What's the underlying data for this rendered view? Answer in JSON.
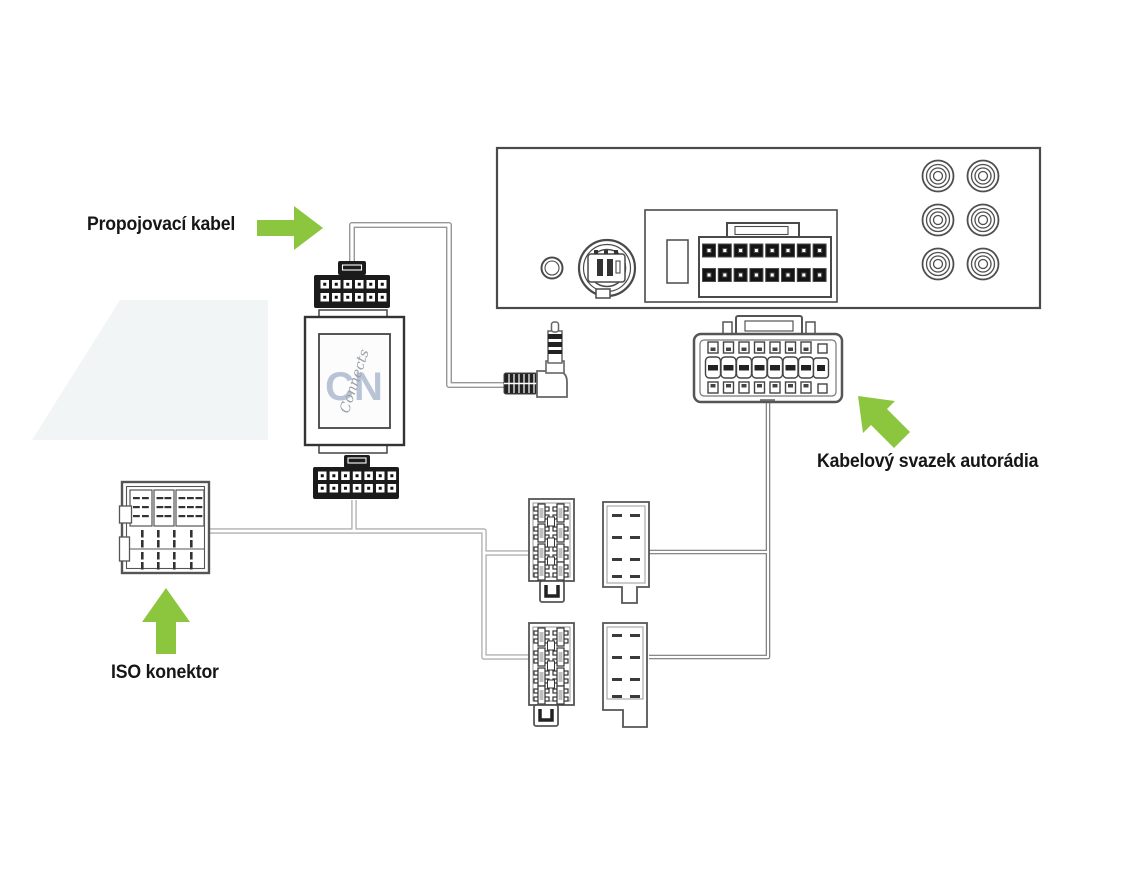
{
  "labels": {
    "propojovaci_kabel": "Propojovací kabel",
    "kabelovy_svazek_autoradia": "Kabelový svazek autorádia",
    "iso_konektor": "ISO konektor"
  },
  "adapter": {
    "logo_main": "CN",
    "logo_script": "Connects"
  },
  "colors": {
    "arrow_green": "#8CC63F",
    "diagram_outline": "#4a4a4a",
    "connector_black": "#1b1b1b",
    "wire_light_gray": "#b0b0b0",
    "wire_dark_gray": "#777777",
    "logo_blue": "#b9c3d6",
    "background": "#ffffff",
    "watermark": "#f2f5f5"
  },
  "components": {
    "radio_rca_jack_count": 6,
    "radio_main_connector_pins": 16,
    "adapter_top_connector_pins": 12,
    "adapter_bottom_connector_pins": 14,
    "harness_terminal_columns": 8,
    "small_plug_count": 2,
    "small_socket_count": 2
  }
}
